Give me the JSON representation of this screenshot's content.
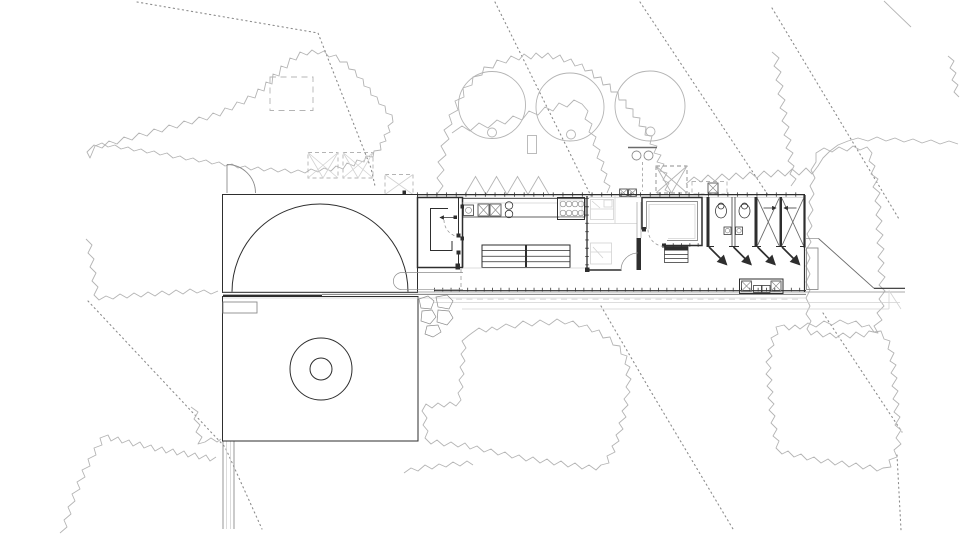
{
  "meta": {
    "title": "Architectural site plan",
    "description": "Black-and-white architectural site plan drawing: a long linear pavilion containing an entry WC, kitchen with counter and long dining table, bedroom, lounge with steps, two bathrooms with toilets and two cross-marked stalls opening onto a boardwalk deck; a square terrace on the left with a semicircular lawn edge and a round fire pit, a garden path, three round trees, dashed roof/skylight markers, irregular tree-canopy outlines and dotted site boundary lines.",
    "canvas": {
      "width": 960,
      "height": 535
    }
  },
  "colors": {
    "background": "#ffffff",
    "ink_dark": "#2e2e2e",
    "ink_mid": "#6a6a6a",
    "ink_medium": "#8c8c8c",
    "ink_light": "#b4b4b4",
    "ink_faint": "#d2d2d2"
  }
}
